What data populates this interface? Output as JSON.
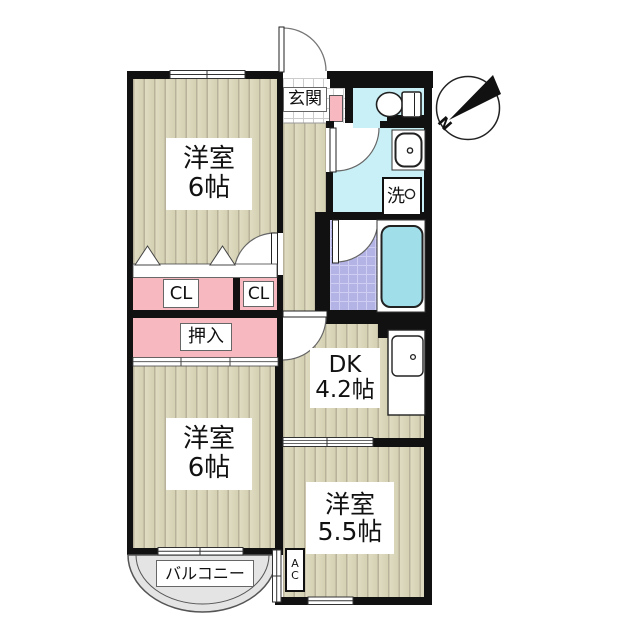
{
  "plan": {
    "type": "apartment-floorplan",
    "compass_label": "N",
    "rooms": {
      "western1": {
        "name": "洋室",
        "size": "6帖"
      },
      "western2": {
        "name": "洋室",
        "size": "6帖"
      },
      "western3": {
        "name": "洋室",
        "size": "5.5帖"
      },
      "dk": {
        "name": "DK",
        "size": "4.2帖"
      },
      "entrance": "玄関",
      "oshiire": "押入",
      "closet_left": "CL",
      "closet_right": "CL",
      "laundry": "洗",
      "balcony": "バルコニー",
      "ac_line1": "A",
      "ac_line2": "C"
    },
    "colors": {
      "wall": "#111111",
      "flooring": "#d8d4b6",
      "closet_pink": "#f7b9bf",
      "wet_area_cyan": "#c9f0f6",
      "bath_tile": "#b4b3e5",
      "bathtub": "#a0dfe9",
      "balcony_gray": "#e4e4e4"
    }
  }
}
